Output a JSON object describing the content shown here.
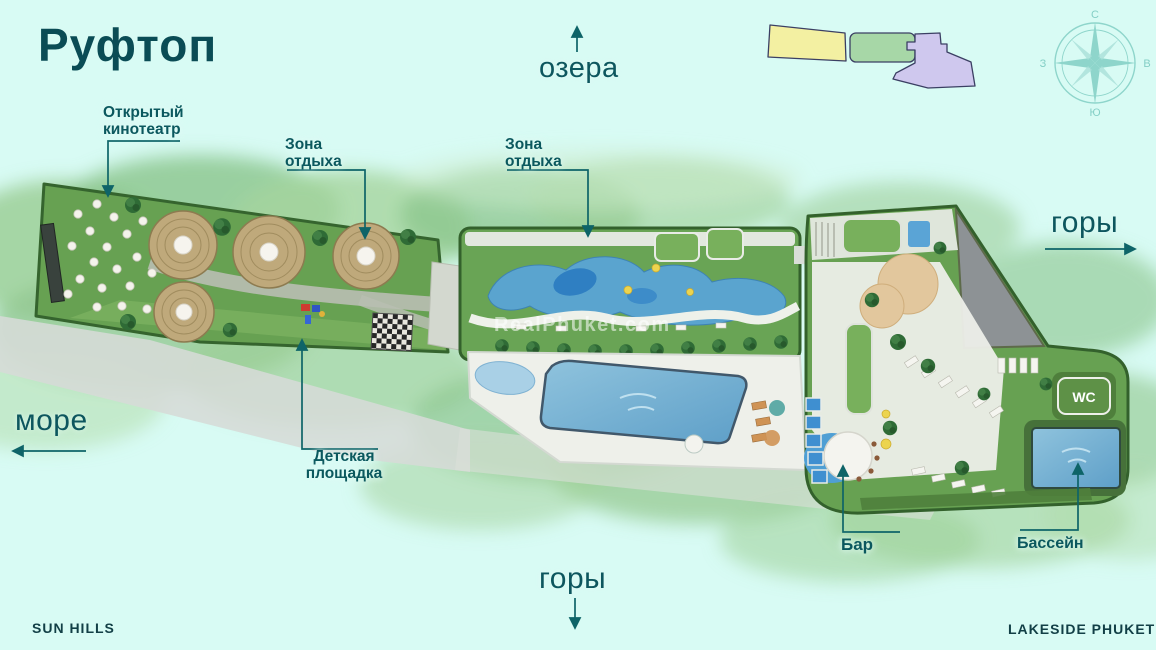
{
  "page": {
    "title": "Руфтоп",
    "footer_left": "SUN HILLS",
    "footer_right": "LAKESIDE PHUKET",
    "watermark": "RealPhuket.com"
  },
  "labels": {
    "cinema_line1": "Открытый",
    "cinema_line2": "кинотеатр",
    "rest1_line1": "Зона",
    "rest1_line2": "отдыха",
    "rest2_line1": "Зона",
    "rest2_line2": "отдыха",
    "playground_line1": "Детская",
    "playground_line2": "площадка",
    "bar": "Бар",
    "pool": "Бассейн",
    "wc": "WC"
  },
  "directions": {
    "north": "озера",
    "east": "горы",
    "south": "горы",
    "west": "море"
  },
  "compass": {
    "north": "С",
    "east": "В",
    "south": "Ю",
    "west": "З"
  },
  "colors": {
    "background": "#d8fbf4",
    "title_text": "#0a4c55",
    "label_text": "#0b585e",
    "leader_line": "#0e6468",
    "minimap_yellow": "#f3f0a2",
    "minimap_green": "#a7d7a7",
    "minimap_purple": "#cfc8ee",
    "plan_green": "#67a152",
    "pool_blue": "#74aecb"
  }
}
